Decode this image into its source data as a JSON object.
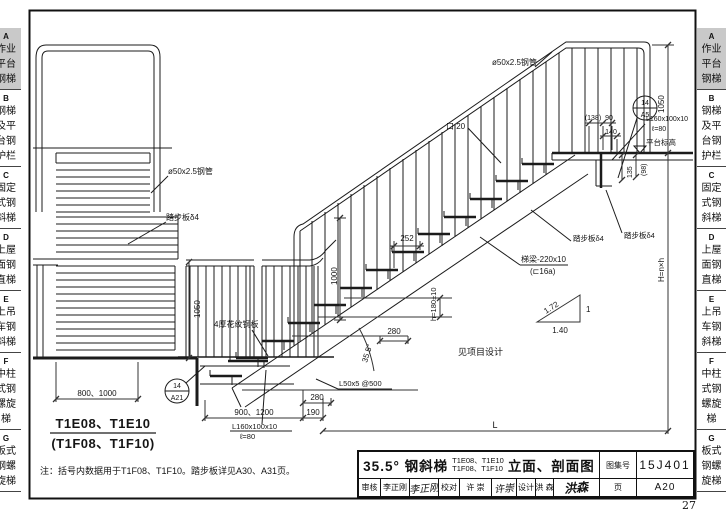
{
  "page": {
    "number": "27"
  },
  "sidebar": {
    "highlight_color": "#c9c9c9",
    "tabs": [
      {
        "letter": "A",
        "rows": [
          "作业",
          "平台",
          "钢梯"
        ]
      },
      {
        "letter": "B",
        "rows": [
          "钢梯",
          "及平",
          "台钢",
          "护栏"
        ]
      },
      {
        "letter": "C",
        "rows": [
          "固定",
          "式钢",
          "斜梯"
        ]
      },
      {
        "letter": "D",
        "rows": [
          "上屋",
          "面钢",
          "直梯"
        ]
      },
      {
        "letter": "E",
        "rows": [
          "上吊",
          "车钢",
          "斜梯"
        ]
      },
      {
        "letter": "F",
        "rows": [
          "中柱",
          "式钢",
          "螺旋",
          "梯"
        ]
      },
      {
        "letter": "G",
        "rows": [
          "板式",
          "钢螺",
          "旋梯"
        ]
      }
    ]
  },
  "title_block": {
    "title_left": "35.5° 钢斜梯",
    "models_line1": "T1E08、T1E10",
    "models_line2": "T1F08、T1F10",
    "title_right": "立面、剖面图",
    "atlas_label": "图集号",
    "atlas_no": "15J401",
    "page_label": "页",
    "page_no": "A20",
    "review_label": "审核",
    "review_name": "李正刚",
    "review_sig": "李正刚",
    "check_label": "校对",
    "check_name": "许 崇",
    "check_sig": "许崇",
    "design_label": "设计",
    "design_name": "洪 森",
    "design_sig": "洪森"
  },
  "drawing": {
    "type_line1": "T1E08、T1E10",
    "type_line2": "(T1F08、T1F10)",
    "note": "注：括号内数据用于T1F08、T1F10。踏步板详见A30、A31页。",
    "labels": {
      "pipe": "ø50x2.5钢管",
      "square_bar": "口 20",
      "tread_plate": "踏步板δ4",
      "stringer_line1": "梯梁-220x10",
      "stringer_line2": "(⊏16a)",
      "angle_cleat": "L160x100x10",
      "angle_cleat_len": "ℓ=80",
      "l50": "L50x5 @500",
      "platform_level": "平台标高",
      "checker_plate": "4厚花纹钢板",
      "see_project": "见项目设计"
    },
    "dims": {
      "d252": "252",
      "d280": "280",
      "d190": "190",
      "d900": "900、1200",
      "d800": "800、1000",
      "h_riser": "h=180±10",
      "H_total": "H=n×h",
      "d1050": "1050",
      "d1000": "1000",
      "d135": "135",
      "d98": "(98)",
      "d138": "(138)",
      "d90": "90",
      "d140": "140",
      "L": "L",
      "angle": "35.5°",
      "slope_hyp": "1.72",
      "slope_v": "1",
      "slope_h": "1.40"
    },
    "callouts": {
      "top": {
        "num": "14",
        "page": "A5"
      },
      "bottom": {
        "num": "14",
        "page": "A21"
      }
    }
  }
}
